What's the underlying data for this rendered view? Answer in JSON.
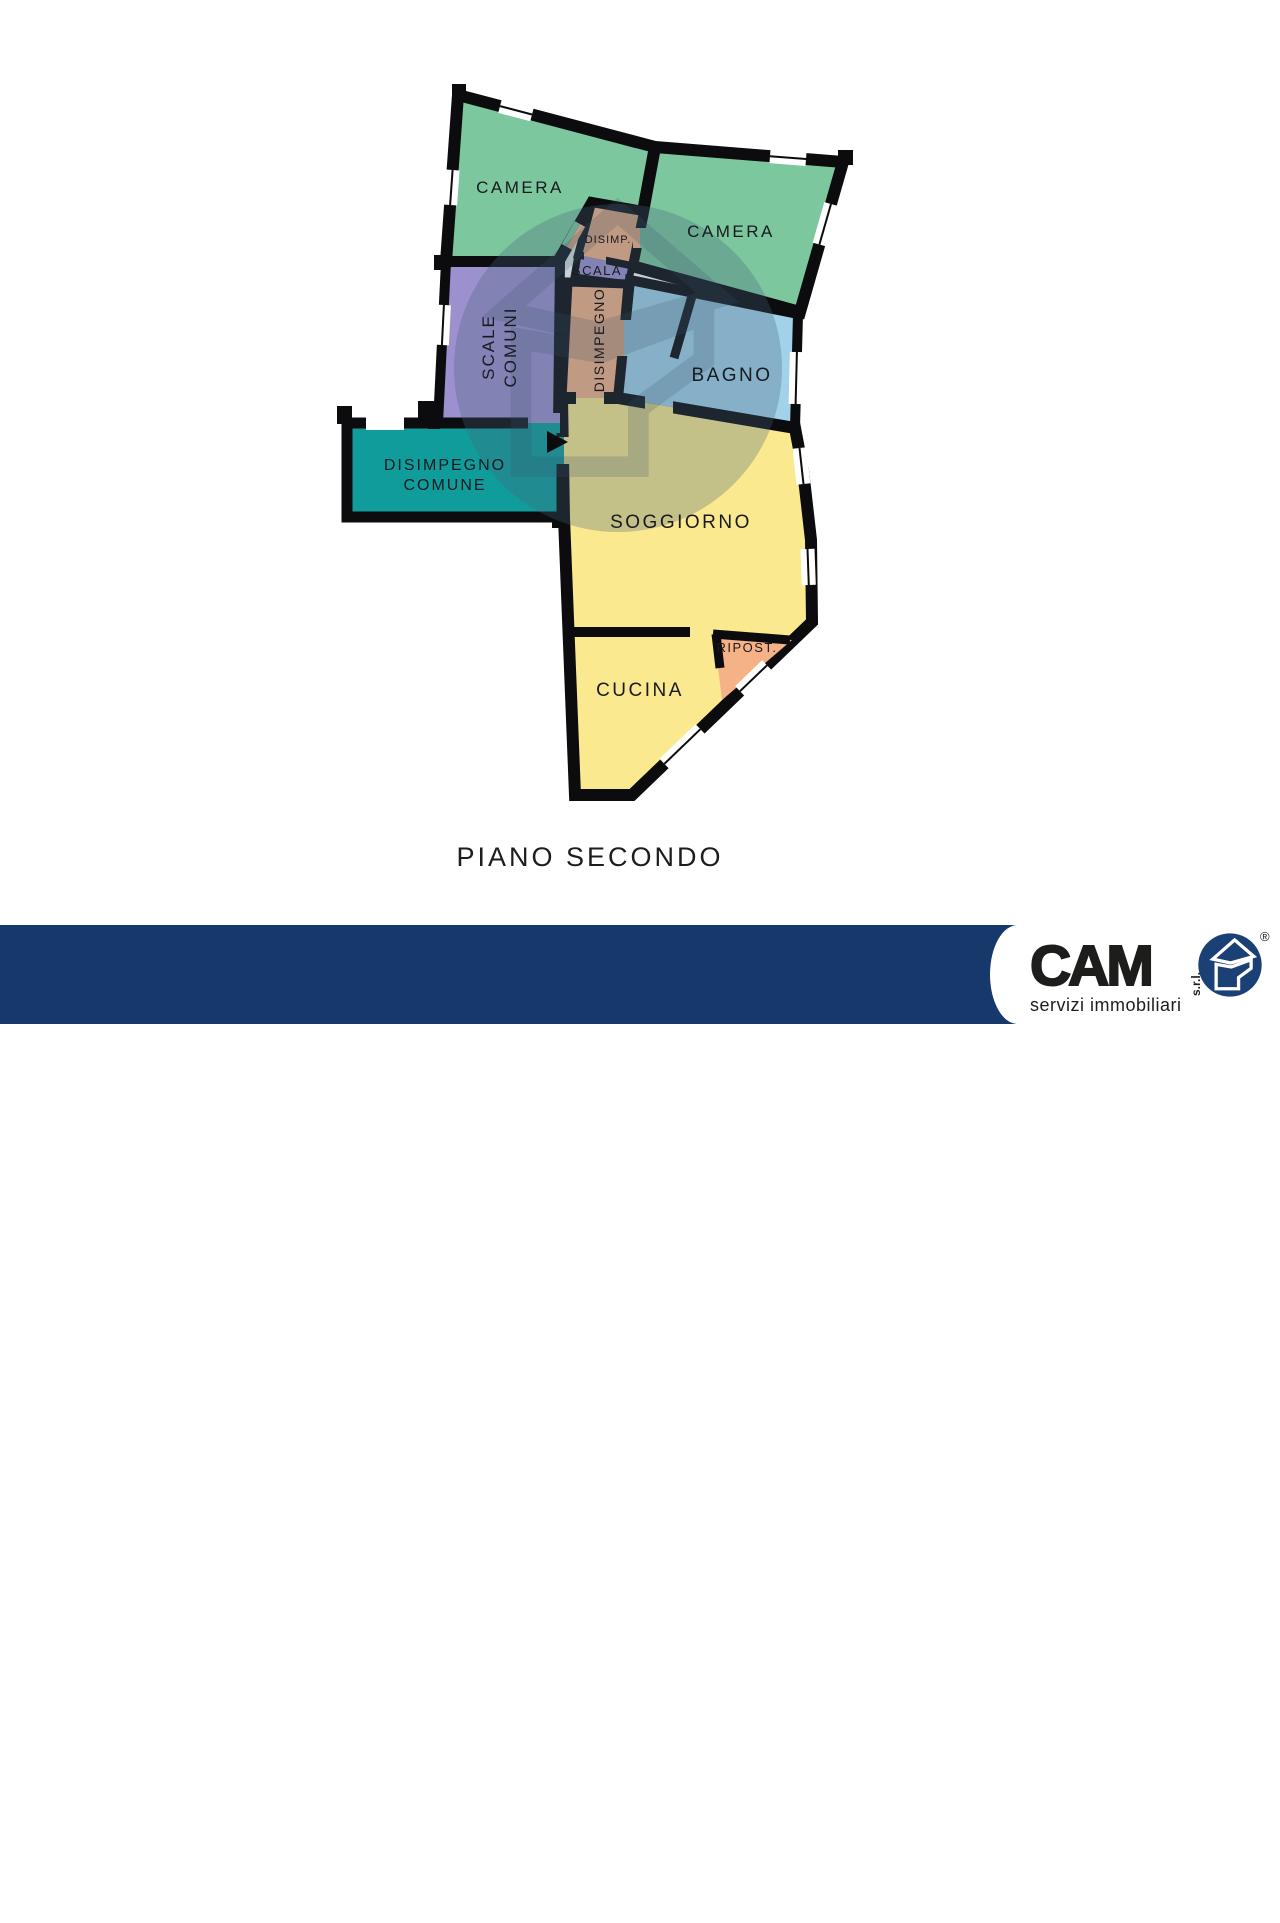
{
  "floorplan": {
    "title": "PIANO SECONDO",
    "rooms": {
      "camera_left": "CAMERA",
      "camera_right": "CAMERA",
      "disimp": "DISIMP.",
      "scala": "SCALA",
      "scale_comuni_line1": "SCALE",
      "scale_comuni_line2": "COMUNI",
      "disimpegno": "DISIMPEGNO",
      "bagno": "BAGNO",
      "disimpegno_comune_line1": "DISIMPEGNO",
      "disimpegno_comune_line2": "COMUNE",
      "soggiorno": "SOGGIORNO",
      "ripostiglio": "RIPOST.",
      "cucina": "CUCINA"
    },
    "colors": {
      "bedroom_green": "#7cc79e",
      "hallway_orange": "#f5b286",
      "stairs_purple": "#9c90cf",
      "bath_blue": "#a2d2ea",
      "common_teal": "#109c9b",
      "living_yellow": "#fae98f",
      "wall_black": "#0c0c0f",
      "watermark_grey": "#46637a"
    }
  },
  "footer": {
    "line1": "APPARTAMENTO",
    "line2": "BRENO",
    "bar_color": "#16386b"
  },
  "logo": {
    "name": "CAM",
    "suffix": "s.r.l.",
    "tagline": "servizi immobiliari",
    "registered_mark": "®",
    "circle_color": "#1a4076"
  }
}
